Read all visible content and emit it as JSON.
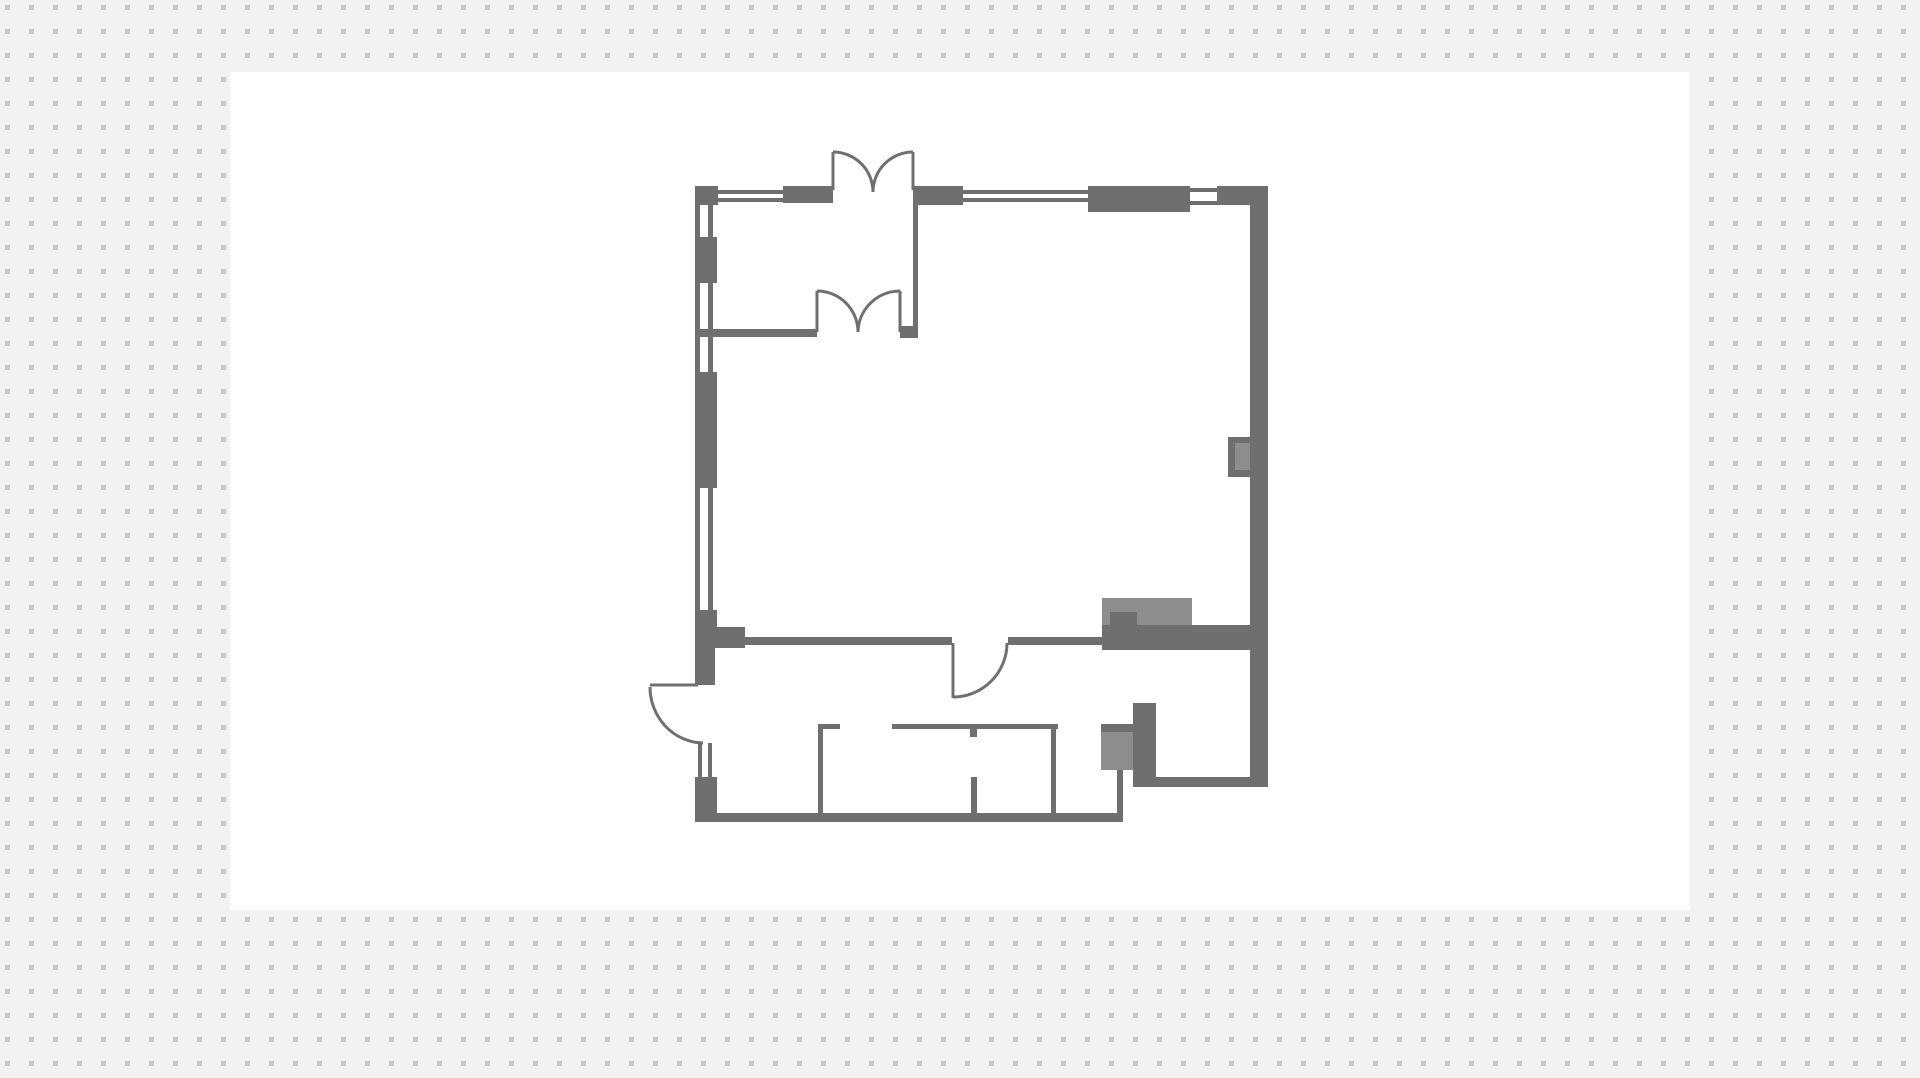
{
  "app": {
    "view_label": "floor-plan-canvas"
  },
  "canvas": {
    "width": 1920,
    "height": 1078,
    "background_color": "#f1f2f1",
    "dot_color": "#c9c9c9",
    "dot_spacing": 24,
    "dot_size": 5,
    "dot_offset": 5,
    "artboard": {
      "x": 230,
      "y": 72,
      "width": 1460,
      "height": 838,
      "color": "#ffffff"
    }
  },
  "floorplan": {
    "wall_color": "#6f6f6f",
    "fixture_color": "#8d8d8d",
    "door_stroke_width": 3,
    "shapes": [
      {
        "name": "kitchen-counter-fixture",
        "x": 1102,
        "y": 598,
        "w": 90,
        "h": 27,
        "fill": "fixture"
      },
      {
        "name": "counter-wall-block",
        "x": 1110,
        "y": 612,
        "w": 27,
        "h": 13,
        "fill": "wall"
      },
      {
        "name": "south-wall-thick-band",
        "x": 1102,
        "y": 625,
        "w": 153,
        "h": 25,
        "fill": "wall"
      },
      {
        "name": "right-wall-fixture-outline",
        "x": 1228,
        "y": 437,
        "w": 22,
        "h": 40,
        "fill": "wall"
      },
      {
        "name": "right-wall-fixture-inner",
        "x": 1235,
        "y": 443,
        "w": 15,
        "h": 27,
        "fill": "fixture"
      },
      {
        "name": "appliance-top-bar",
        "x": 1101,
        "y": 724,
        "w": 32,
        "h": 8,
        "fill": "wall"
      },
      {
        "name": "appliance-fixture",
        "x": 1101,
        "y": 732,
        "w": 32,
        "h": 38,
        "fill": "fixture"
      },
      {
        "name": "storage-room-wall-block",
        "x": 1133,
        "y": 703,
        "w": 23,
        "h": 84,
        "fill": "wall"
      },
      {
        "name": "top-wall-corner-tl",
        "x": 695,
        "y": 186,
        "w": 23,
        "h": 19,
        "fill": "wall"
      },
      {
        "name": "top-window-1-outer",
        "x": 718,
        "y": 190,
        "w": 65,
        "h": 4,
        "fill": "wall"
      },
      {
        "name": "top-window-1-inner",
        "x": 718,
        "y": 198,
        "w": 65,
        "h": 4,
        "fill": "wall"
      },
      {
        "name": "top-wall-seg-1",
        "x": 783,
        "y": 186,
        "w": 50,
        "h": 17,
        "fill": "wall"
      },
      {
        "name": "top-wall-seg-2",
        "x": 913,
        "y": 186,
        "w": 50,
        "h": 19,
        "fill": "wall"
      },
      {
        "name": "top-window-2-outer",
        "x": 963,
        "y": 190,
        "w": 125,
        "h": 4,
        "fill": "wall"
      },
      {
        "name": "top-window-2-inner",
        "x": 963,
        "y": 198,
        "w": 125,
        "h": 4,
        "fill": "wall"
      },
      {
        "name": "top-wall-seg-3-thick",
        "x": 1088,
        "y": 186,
        "w": 102,
        "h": 26,
        "fill": "wall"
      },
      {
        "name": "top-window-3-outer",
        "x": 1190,
        "y": 188,
        "w": 27,
        "h": 4,
        "fill": "wall"
      },
      {
        "name": "top-window-3-inner",
        "x": 1190,
        "y": 201,
        "w": 27,
        "h": 4,
        "fill": "wall"
      },
      {
        "name": "top-wall-corner-tr",
        "x": 1217,
        "y": 186,
        "w": 51,
        "h": 19,
        "fill": "wall"
      },
      {
        "name": "left-window-a-outer",
        "x": 695,
        "y": 205,
        "w": 5,
        "h": 32,
        "fill": "wall"
      },
      {
        "name": "left-window-a-inner",
        "x": 708,
        "y": 205,
        "w": 5,
        "h": 32,
        "fill": "wall"
      },
      {
        "name": "left-wall-seg-1",
        "x": 695,
        "y": 237,
        "w": 22,
        "h": 46,
        "fill": "wall"
      },
      {
        "name": "left-window-b-outer",
        "x": 695,
        "y": 283,
        "w": 5,
        "h": 46,
        "fill": "wall"
      },
      {
        "name": "left-window-b-inner",
        "x": 708,
        "y": 283,
        "w": 5,
        "h": 46,
        "fill": "wall"
      },
      {
        "name": "left-window-c-outer",
        "x": 695,
        "y": 337,
        "w": 5,
        "h": 35,
        "fill": "wall"
      },
      {
        "name": "left-window-c-inner",
        "x": 708,
        "y": 337,
        "w": 5,
        "h": 35,
        "fill": "wall"
      },
      {
        "name": "left-wall-seg-2",
        "x": 695,
        "y": 372,
        "w": 22,
        "h": 116,
        "fill": "wall"
      },
      {
        "name": "left-window-d-outer",
        "x": 695,
        "y": 488,
        "w": 5,
        "h": 122,
        "fill": "wall"
      },
      {
        "name": "left-window-d-inner",
        "x": 708,
        "y": 488,
        "w": 5,
        "h": 122,
        "fill": "wall"
      },
      {
        "name": "left-wall-seg-3",
        "x": 695,
        "y": 610,
        "w": 22,
        "h": 17,
        "fill": "wall"
      },
      {
        "name": "left-wall-pier",
        "x": 695,
        "y": 627,
        "w": 50,
        "h": 21,
        "fill": "wall"
      },
      {
        "name": "left-wall-seg-4",
        "x": 695,
        "y": 648,
        "w": 20,
        "h": 37,
        "fill": "wall"
      },
      {
        "name": "left-window-e-outer",
        "x": 698,
        "y": 743,
        "w": 4,
        "h": 34,
        "fill": "wall"
      },
      {
        "name": "left-window-e-inner",
        "x": 708,
        "y": 743,
        "w": 4,
        "h": 34,
        "fill": "wall"
      },
      {
        "name": "left-wall-corner-bl",
        "x": 695,
        "y": 777,
        "w": 22,
        "h": 45,
        "fill": "wall"
      },
      {
        "name": "bottom-wall",
        "x": 695,
        "y": 813,
        "w": 428,
        "h": 9,
        "fill": "wall"
      },
      {
        "name": "bottom-step-wall",
        "x": 1117,
        "y": 770,
        "w": 6,
        "h": 45,
        "fill": "wall"
      },
      {
        "name": "south-wall-thin-left",
        "x": 745,
        "y": 637,
        "w": 207,
        "h": 8,
        "fill": "wall"
      },
      {
        "name": "south-wall-thin-right",
        "x": 1008,
        "y": 637,
        "w": 94,
        "h": 8,
        "fill": "wall"
      },
      {
        "name": "right-wall",
        "x": 1250,
        "y": 205,
        "w": 18,
        "h": 582,
        "fill": "wall"
      },
      {
        "name": "storage-room-bottom-wall",
        "x": 1150,
        "y": 777,
        "w": 118,
        "h": 10,
        "fill": "wall"
      },
      {
        "name": "vestibule-right-wall",
        "x": 913,
        "y": 203,
        "w": 5,
        "h": 134,
        "fill": "wall"
      },
      {
        "name": "vestibule-bottom-wall",
        "x": 695,
        "y": 329,
        "w": 122,
        "h": 8,
        "fill": "wall"
      },
      {
        "name": "vestibule-door-jamb-block",
        "x": 900,
        "y": 326,
        "w": 18,
        "h": 12,
        "fill": "wall"
      },
      {
        "name": "wc-partition-tick",
        "x": 818,
        "y": 724,
        "w": 22,
        "h": 5,
        "fill": "wall"
      },
      {
        "name": "wc-partition-left",
        "x": 818,
        "y": 724,
        "w": 5,
        "h": 91,
        "fill": "wall"
      },
      {
        "name": "wc-stall-top-bar",
        "x": 892,
        "y": 724,
        "w": 166,
        "h": 5,
        "fill": "wall"
      },
      {
        "name": "wc-stall-right-wall",
        "x": 1051,
        "y": 729,
        "w": 5,
        "h": 84,
        "fill": "wall"
      },
      {
        "name": "wc-stall-divider-top",
        "x": 970,
        "y": 729,
        "w": 7,
        "h": 8,
        "fill": "wall"
      },
      {
        "name": "wc-stall-divider-bottom",
        "x": 971,
        "y": 777,
        "w": 6,
        "h": 38,
        "fill": "wall"
      }
    ],
    "doors": [
      {
        "name": "entrance-double-door-left-panel",
        "d": "M833,190 V152"
      },
      {
        "name": "entrance-double-door-left-swing",
        "d": "M833,152 A40,40 0 0 1 873,192"
      },
      {
        "name": "entrance-double-door-right-panel",
        "d": "M913,190 V152"
      },
      {
        "name": "entrance-double-door-right-swing",
        "d": "M913,152 A40,40 0 0 0 873,192"
      },
      {
        "name": "vestibule-double-door-left-panel",
        "d": "M817,332 V291"
      },
      {
        "name": "vestibule-double-door-left-swing",
        "d": "M817,291 A41,41 0 0 1 858,332"
      },
      {
        "name": "vestibule-double-door-right-panel",
        "d": "M900,332 V291"
      },
      {
        "name": "vestibule-double-door-right-swing",
        "d": "M900,291 A42,42 0 0 0 858,332"
      },
      {
        "name": "side-exit-door-panel",
        "d": "M650,685 H698"
      },
      {
        "name": "side-exit-door-swing",
        "d": "M650,687 A54,56 0 0 0 703,743"
      },
      {
        "name": "hall-door-panel",
        "d": "M953,643 V698"
      },
      {
        "name": "hall-door-swing",
        "d": "M1007,643 A54,54 0 0 1 953,697"
      }
    ]
  }
}
